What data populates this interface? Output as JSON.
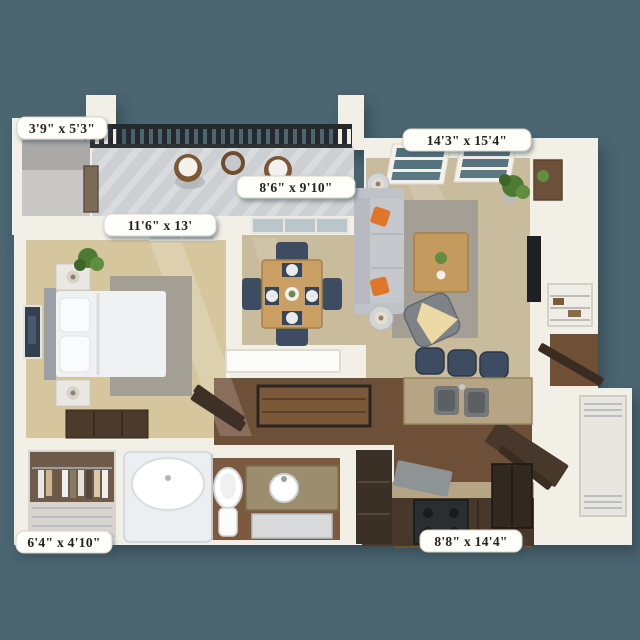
{
  "labels": {
    "storage_room": "3'9\" x 5'3\"",
    "bedroom": "11'6\" x 13'",
    "patio": "8'6\" x 9'10\"",
    "living_room": "14'3\" x 15'4\"",
    "closet": "6'4\" x 4'10\"",
    "kitchen": "8'8\" x 14'4\""
  },
  "colors": {
    "background": "#4b6571",
    "wall": "#f2efe7",
    "wall_shade": "#dcd6c9",
    "carpet_bedroom": "#d6c69e",
    "carpet_living": "#c9bc9d",
    "wood_floor": "#6e4f37",
    "wood_floor_dark": "#3a3026",
    "balcony_floor": "#ccd0d3",
    "railing": "#26292c",
    "rug": "#a49f95",
    "bed_linen": "#f0f1f3",
    "sofa": "#c5c8cd",
    "accent_orange": "#e0762a",
    "navy": "#3d4c60",
    "granite": "#b5a584",
    "cabinet": "#48382b",
    "stainless": "#8e9496",
    "plant": "#4e7a34",
    "label_bg": "#fdfdfa",
    "label_text": "#27221d"
  }
}
